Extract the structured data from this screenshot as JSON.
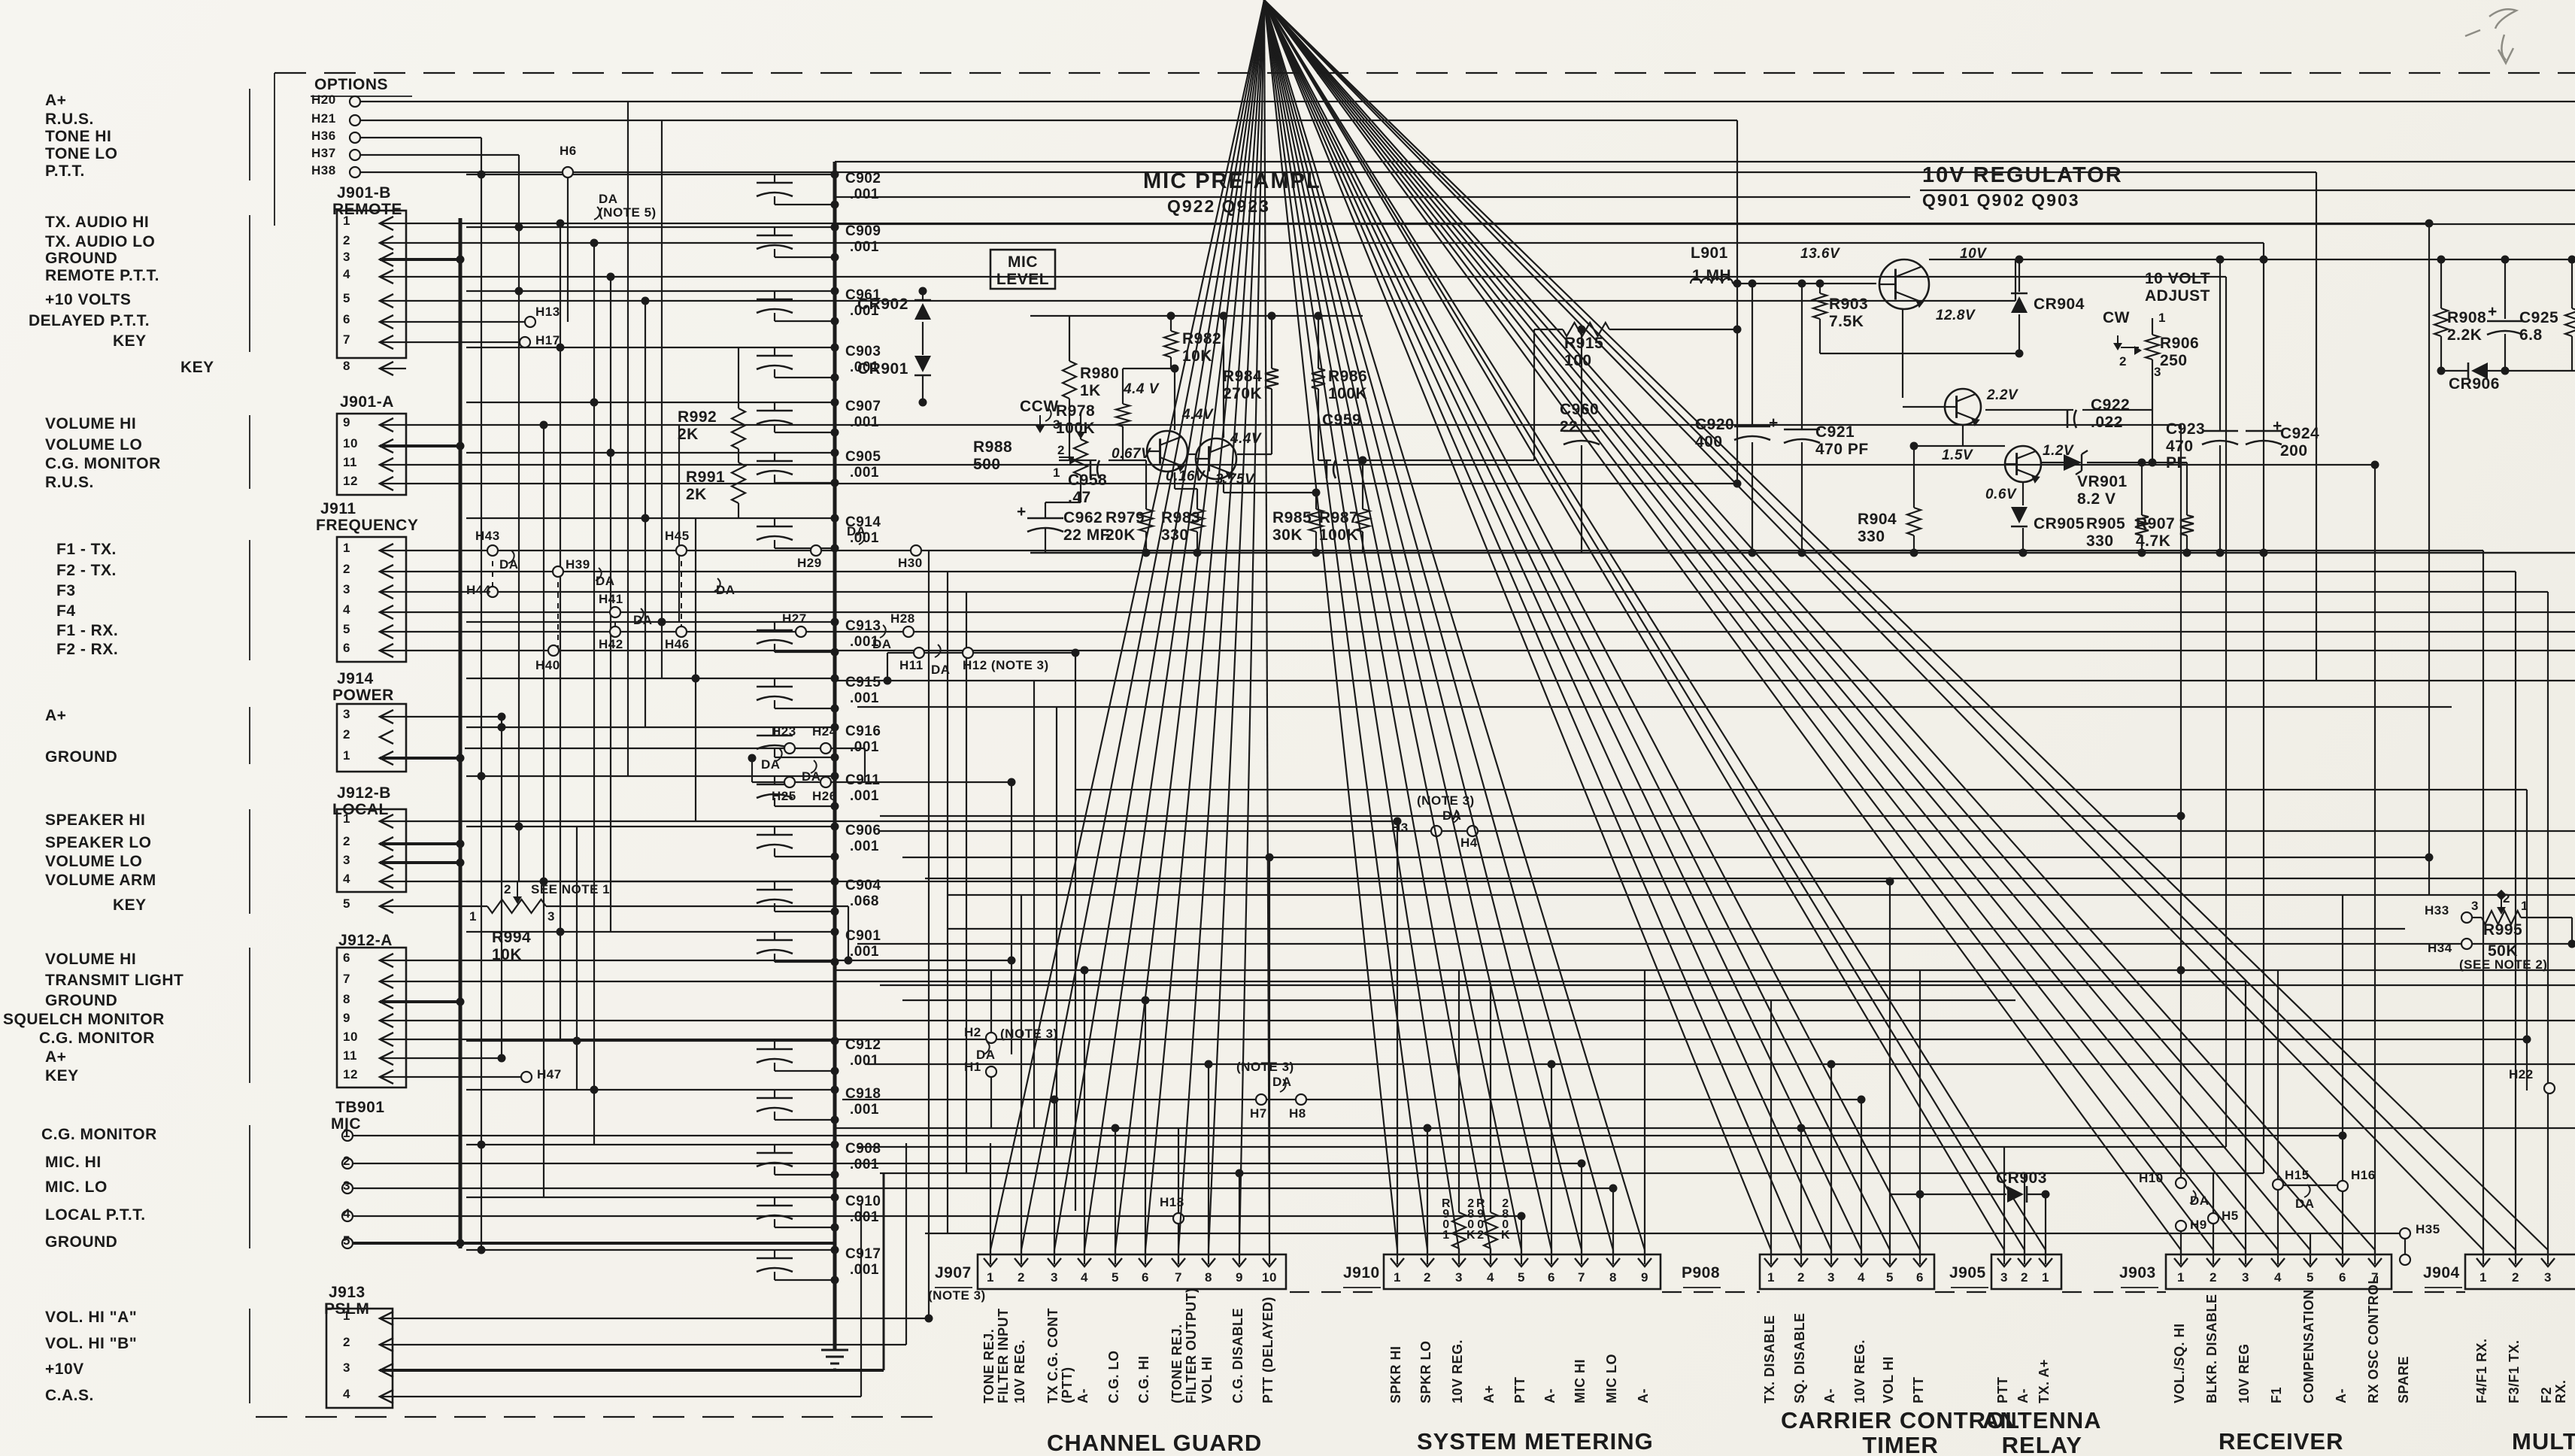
{
  "options": {
    "title": "OPTIONS",
    "rows": [
      {
        "pad": "H20",
        "label": "A+"
      },
      {
        "pad": "H21",
        "label": "R.U.S."
      },
      {
        "pad": "H36",
        "label": "TONE HI"
      },
      {
        "pad": "H37",
        "label": "TONE LO"
      },
      {
        "pad": "H38",
        "label": "P.T.T."
      }
    ]
  },
  "left_connectors": [
    {
      "id": "J901-B",
      "name": "REMOTE",
      "pins": [
        [
          "1",
          "TX. AUDIO HI"
        ],
        [
          "2",
          "TX. AUDIO LO"
        ],
        [
          "3",
          "GROUND"
        ],
        [
          "4",
          "REMOTE P.T.T."
        ],
        [
          "5",
          "+10 VOLTS"
        ],
        [
          "6",
          "DELAYED P.T.T."
        ],
        [
          "7",
          "KEY"
        ]
      ],
      "extra": [
        [
          "8",
          "KEY"
        ]
      ]
    },
    {
      "id": "J901-A",
      "name": "",
      "pins": [
        [
          "9",
          "VOLUME HI"
        ],
        [
          "10",
          "VOLUME LO"
        ],
        [
          "11",
          "C.G. MONITOR"
        ],
        [
          "12",
          "R.U.S."
        ]
      ],
      "extra": []
    },
    {
      "id": "J911",
      "name": "FREQUENCY",
      "pins": [
        [
          "1",
          "F1 - TX."
        ],
        [
          "2",
          "F2 - TX."
        ],
        [
          "3",
          "F3"
        ],
        [
          "4",
          "F4"
        ],
        [
          "5",
          "F1 - RX."
        ],
        [
          "6",
          "F2 - RX."
        ]
      ],
      "extra": []
    },
    {
      "id": "J914",
      "name": "POWER",
      "pins": [
        [
          "3",
          "A+"
        ],
        [
          "2",
          ""
        ],
        [
          "1",
          "GROUND"
        ]
      ],
      "extra": []
    },
    {
      "id": "J912-B",
      "name": "LOCAL",
      "pins": [
        [
          "1",
          "SPEAKER HI"
        ],
        [
          "2",
          "SPEAKER LO"
        ],
        [
          "3",
          "VOLUME LO"
        ],
        [
          "4",
          "VOLUME ARM"
        ]
      ],
      "extra": [
        [
          "5",
          "KEY"
        ]
      ]
    },
    {
      "id": "J912-A",
      "name": "",
      "pins": [
        [
          "6",
          "VOLUME HI"
        ],
        [
          "7",
          "TRANSMIT LIGHT"
        ],
        [
          "8",
          "GROUND"
        ],
        [
          "9",
          "SQUELCH MONITOR"
        ],
        [
          "10",
          "C.G. MONITOR"
        ],
        [
          "11",
          "A+"
        ],
        [
          "12",
          "KEY"
        ]
      ],
      "extra": []
    },
    {
      "id": "TB901",
      "name": "MIC",
      "pins": [
        [
          "1",
          "C.G. MONITOR"
        ],
        [
          "2",
          "MIC. HI"
        ],
        [
          "3",
          "MIC. LO"
        ],
        [
          "4",
          "LOCAL P.T.T."
        ],
        [
          "5",
          "GROUND"
        ]
      ],
      "extra": []
    },
    {
      "id": "J913",
      "name": "PSLM",
      "pins": [
        [
          "1",
          "VOL. HI \"A\""
        ],
        [
          "2",
          "VOL. HI \"B\""
        ],
        [
          "3",
          "+10V"
        ],
        [
          "4",
          "C.A.S."
        ]
      ],
      "extra": []
    }
  ],
  "capacitor_chain": [
    [
      "C902",
      ".001"
    ],
    [
      "C909",
      ".001"
    ],
    [
      "C961",
      ".001"
    ],
    [
      "C903",
      ".001"
    ],
    [
      "C907",
      ".001"
    ],
    [
      "C905",
      ".001"
    ],
    [
      "C914",
      ".001"
    ],
    [
      "C913",
      ".001"
    ],
    [
      "C915",
      ".001"
    ],
    [
      "C916",
      ".001"
    ],
    [
      "C911",
      ".001"
    ],
    [
      "C906",
      ".001"
    ],
    [
      "C904",
      ".068"
    ],
    [
      "C901",
      ".001"
    ],
    [
      "C912",
      ".001"
    ],
    [
      "C918",
      ".001"
    ],
    [
      "C908",
      ".001"
    ],
    [
      "C910",
      ".001"
    ],
    [
      "C917",
      ".001"
    ]
  ],
  "mic": {
    "title": "MIC PRE-AMPL",
    "devices": "Q922   Q923",
    "level": "MIC\nLEVEL",
    "parts": {
      "r988": "R988\n500",
      "ccw": "CCW",
      "c958": "C958\n.47",
      "c962": "C962\n22 MF",
      "r980": "R980\n1K",
      "r978": "R978\n100K",
      "r982": "R982\n10K",
      "r979": "R979\n20K",
      "r983": "R983\n330",
      "r984": "R984\n270K",
      "r985": "R985\n30K",
      "r986": "R986\n100K",
      "r987": "R987\n100K",
      "c959": "C959",
      "v1": "4.4 V",
      "v2": "4.4V",
      "v3": "4.4V",
      "v4": "0.67V",
      "v5": "0.16V",
      "v6": "3.75V"
    }
  },
  "reg": {
    "title": "10V REGULATOR",
    "devices": "Q901  Q902  Q903",
    "adjust": "10 VOLT\nADJUST",
    "cw": "CW",
    "parts": {
      "l901": "L901",
      "l901v": "1 MH",
      "r903": "R903\n7.5K",
      "c920": "C920\n400",
      "c921": "C921\n470 PF",
      "r904": "R904\n330",
      "cr904": "CR904",
      "cr905": "CR905",
      "c922": "C922\n.022",
      "vr901": "VR901\n8.2 V",
      "r905": "R905\n330",
      "r906": "R906\n250",
      "c923": "C923\n470\nPF",
      "r907": "R907\n4.7K",
      "c924": "C924\n200",
      "r908": "R908\n2.2K",
      "c925": "C925\n6.8",
      "cr906": "CR906",
      "v136": "13.6V",
      "v10": "10V",
      "v128": "12.8V",
      "v22": "2.2V",
      "v15": "1.5V",
      "v12": "1.2V",
      "v06": "0.6V"
    }
  },
  "misc": {
    "cr902": "CR902",
    "cr901": "CR901",
    "r992": "R992\n2K",
    "r991": "R991\n2K",
    "r915": "R915\n100",
    "c960": "C960\n22",
    "r994": "R994\n10K",
    "see1": "SEE NOTE 1",
    "r995": "R995",
    "r995v": "50K",
    "see2": "(SEE NOTE 2)",
    "r901": "R\n9\n0\n1",
    "r901v": "2\n8\n0\nK",
    "r902": "R\n9\n0\n2",
    "r902v": "2\n8\n0\nK",
    "cr903": "CR903"
  },
  "pin_nums": {
    "n1": "1",
    "n2": "2",
    "n3": "3"
  },
  "sym": {
    "plus": "+"
  },
  "jumpers": {
    "h6": "H6",
    "h13": "H13",
    "h17": "H17",
    "h43": "H43",
    "h45": "H45",
    "h29": "H29",
    "h30": "H30",
    "h39": "H39",
    "h44": "H44",
    "h41": "H41",
    "h42": "H42",
    "h46": "H46",
    "h27": "H27",
    "h28": "H28",
    "h40": "H40",
    "h23": "H23",
    "h24": "H24",
    "h25": "H25",
    "h26": "H26",
    "h47": "H47",
    "h11": "H11",
    "h12": "H12 (NOTE 3)",
    "h3": "H3",
    "h4": "H4",
    "h2": "H2",
    "h1": "H1",
    "h7": "H7",
    "h8": "H8",
    "h18": "H18",
    "h10": "H10",
    "h9": "H9",
    "h5": "H5",
    "h15": "H15",
    "h16": "H16",
    "h35": "H35",
    "h22": "H22",
    "h33": "H33",
    "h34": "H34",
    "da": "DA",
    "da_note5": "DA\n(NOTE 5)",
    "note3": "(NOTE 3)"
  },
  "bottom": {
    "spare": "SPARE",
    "sections": [
      {
        "conn": "J907",
        "note": "(NOTE 3)",
        "section": "CHANNEL GUARD",
        "pins": [
          [
            "1",
            "TONE REJ.\nFILTER INPUT"
          ],
          [
            "2",
            "10V REG."
          ],
          [
            "3",
            "TX C.G. CONT\n(PTT)"
          ],
          [
            "4",
            "A-"
          ],
          [
            "5",
            "C.G. LO"
          ],
          [
            "6",
            "C.G. HI"
          ],
          [
            "7",
            "(TONE REJ.\nFILTER OUTPUT)"
          ],
          [
            "8",
            "VOL HI"
          ],
          [
            "9",
            "C.G. DISABLE"
          ],
          [
            "10",
            "PTT (DELAYED)"
          ]
        ]
      },
      {
        "conn": "J910",
        "note": "",
        "section": "SYSTEM METERING",
        "pins": [
          [
            "1",
            "SPKR HI"
          ],
          [
            "2",
            "SPKR LO"
          ],
          [
            "3",
            "10V REG."
          ],
          [
            "4",
            "A+"
          ],
          [
            "5",
            "PTT"
          ],
          [
            "6",
            "A-"
          ],
          [
            "7",
            "MIC HI"
          ],
          [
            "8",
            "MIC LO"
          ],
          [
            "9",
            "A-"
          ]
        ]
      },
      {
        "conn": "P908",
        "note": "",
        "section": "CARRIER CONTROL\nTIMER",
        "pins": [
          [
            "1",
            "TX. DISABLE"
          ],
          [
            "2",
            "SQ. DISABLE"
          ],
          [
            "3",
            "A-"
          ],
          [
            "4",
            "10V REG."
          ],
          [
            "5",
            "VOL HI"
          ],
          [
            "6",
            "PTT"
          ]
        ]
      },
      {
        "conn": "J905",
        "note": "",
        "section": "ANTENNA\nRELAY",
        "pins": [
          [
            "3",
            "PTT"
          ],
          [
            "2",
            "A-"
          ],
          [
            "1",
            "TX. A+"
          ]
        ]
      },
      {
        "conn": "J903",
        "note": "",
        "section": "RECEIVER",
        "pins": [
          [
            "1",
            "VOL./SQ. HI"
          ],
          [
            "2",
            "BLKR. DISABLE"
          ],
          [
            "3",
            "10V REG"
          ],
          [
            "4",
            "F1"
          ],
          [
            "5",
            "COMPENSATION"
          ],
          [
            "6",
            "A-"
          ],
          [
            "7",
            "RX OSC CONTROL"
          ]
        ]
      },
      {
        "conn": "J904",
        "note": "",
        "section": "MULTI",
        "pins": [
          [
            "1",
            "F4/F1 RX."
          ],
          [
            "2",
            "F3/F1 TX."
          ],
          [
            "3",
            "F2 RX."
          ]
        ]
      }
    ]
  }
}
